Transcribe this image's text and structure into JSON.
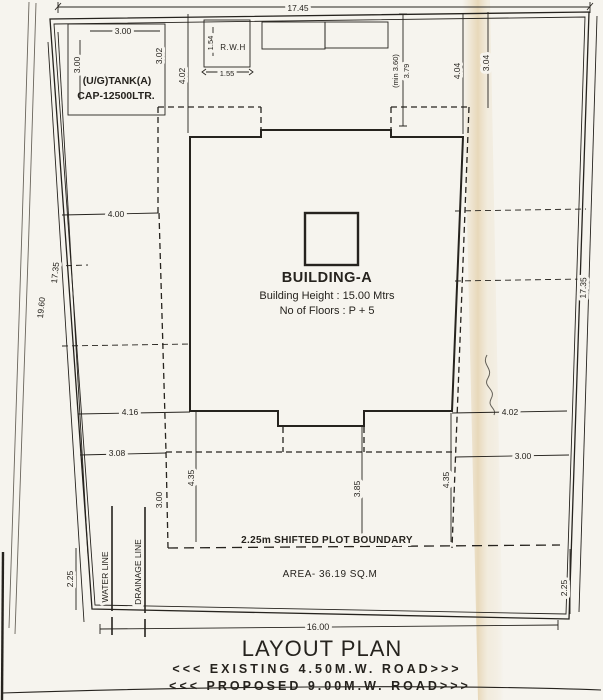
{
  "document": {
    "title": "LAYOUT PLAN"
  },
  "building": {
    "name": "BUILDING-A",
    "height": "Building Height : 15.00 Mtrs",
    "floors": "No of Floors : P + 5"
  },
  "tank": {
    "label1": "(U/G)TANK(A)",
    "label2": "CAP-12500LTR."
  },
  "rwh": {
    "label": "R.W.H"
  },
  "notes": {
    "shifted_boundary": "2.25m  SHIFTED PLOT BOUNDARY",
    "area": "AREA- 36.19 SQ.M"
  },
  "utilities": {
    "water": "WATER LINE",
    "drainage": "DRAINAGE LINE"
  },
  "roads": {
    "existing": "<<< EXISTING  4.50M.W.  ROAD>>>",
    "proposed": "<<< PROPOSED  9.00M.W.  ROAD>>>"
  },
  "dims": {
    "plot_top": "17.45",
    "plot_bottom": "16.00",
    "left_inner": "17.35",
    "left_outer": "19.60",
    "right_side": "17.35",
    "tank_w": "3.00",
    "tank_h": "3.00",
    "tank_side": "3.02",
    "tank_gap": "4.02",
    "rwh_h": "1.54",
    "rwh_w": "1.55",
    "front_setback": "3.79",
    "front_setback_min": "(min 3.60)",
    "front_right": "4.04",
    "front_right2": "3.04",
    "side_left": "4.00",
    "rear_left": "4.16",
    "rear_left2": "3.08",
    "rear_right": "4.02",
    "rear_right2": "3.00",
    "col_left": "4.35",
    "col_left2": "3.00",
    "col_mid": "3.85",
    "col_right": "4.35",
    "shift_left": "2.25",
    "shift_right": "2.25"
  },
  "colors": {
    "paper": "#f6f4ee",
    "ink": "#26231e",
    "crease": "#e7d7b9"
  }
}
